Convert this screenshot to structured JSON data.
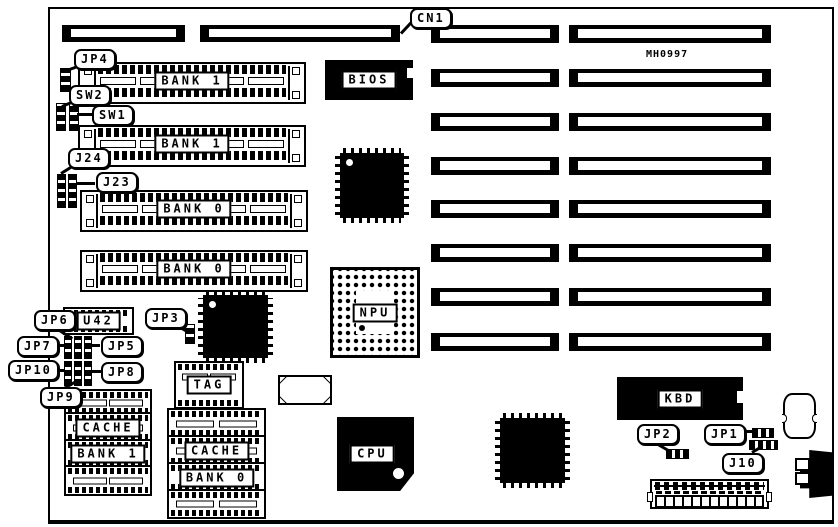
{
  "board": {
    "part_number": "MH0997",
    "memory": {
      "simm_sockets": [
        {
          "label": "BANK 1"
        },
        {
          "label": "BANK 1"
        },
        {
          "label": "BANK 0"
        },
        {
          "label": "BANK 0"
        }
      ]
    },
    "chips": {
      "bios": "BIOS",
      "npu": "NPU",
      "cpu": "CPU",
      "kbd": "KBD",
      "u42": "U42",
      "tag": "TAG"
    },
    "cache": {
      "left": {
        "line1": "CACHE",
        "line2": "BANK 1"
      },
      "right": {
        "line1": "CACHE",
        "line2": "BANK 0"
      }
    },
    "callouts": {
      "cn1": "CN1",
      "jp4": "JP4",
      "sw2": "SW2",
      "sw1": "SW1",
      "j24": "J24",
      "j23": "J23",
      "jp6": "JP6",
      "jp3": "JP3",
      "jp7": "JP7",
      "jp5": "JP5",
      "jp10": "JP10",
      "jp8": "JP8",
      "jp9": "JP9",
      "jp2": "JP2",
      "jp1": "JP1",
      "j10": "J10"
    },
    "colors": {
      "ink": "#000000",
      "paper": "#ffffff"
    }
  }
}
